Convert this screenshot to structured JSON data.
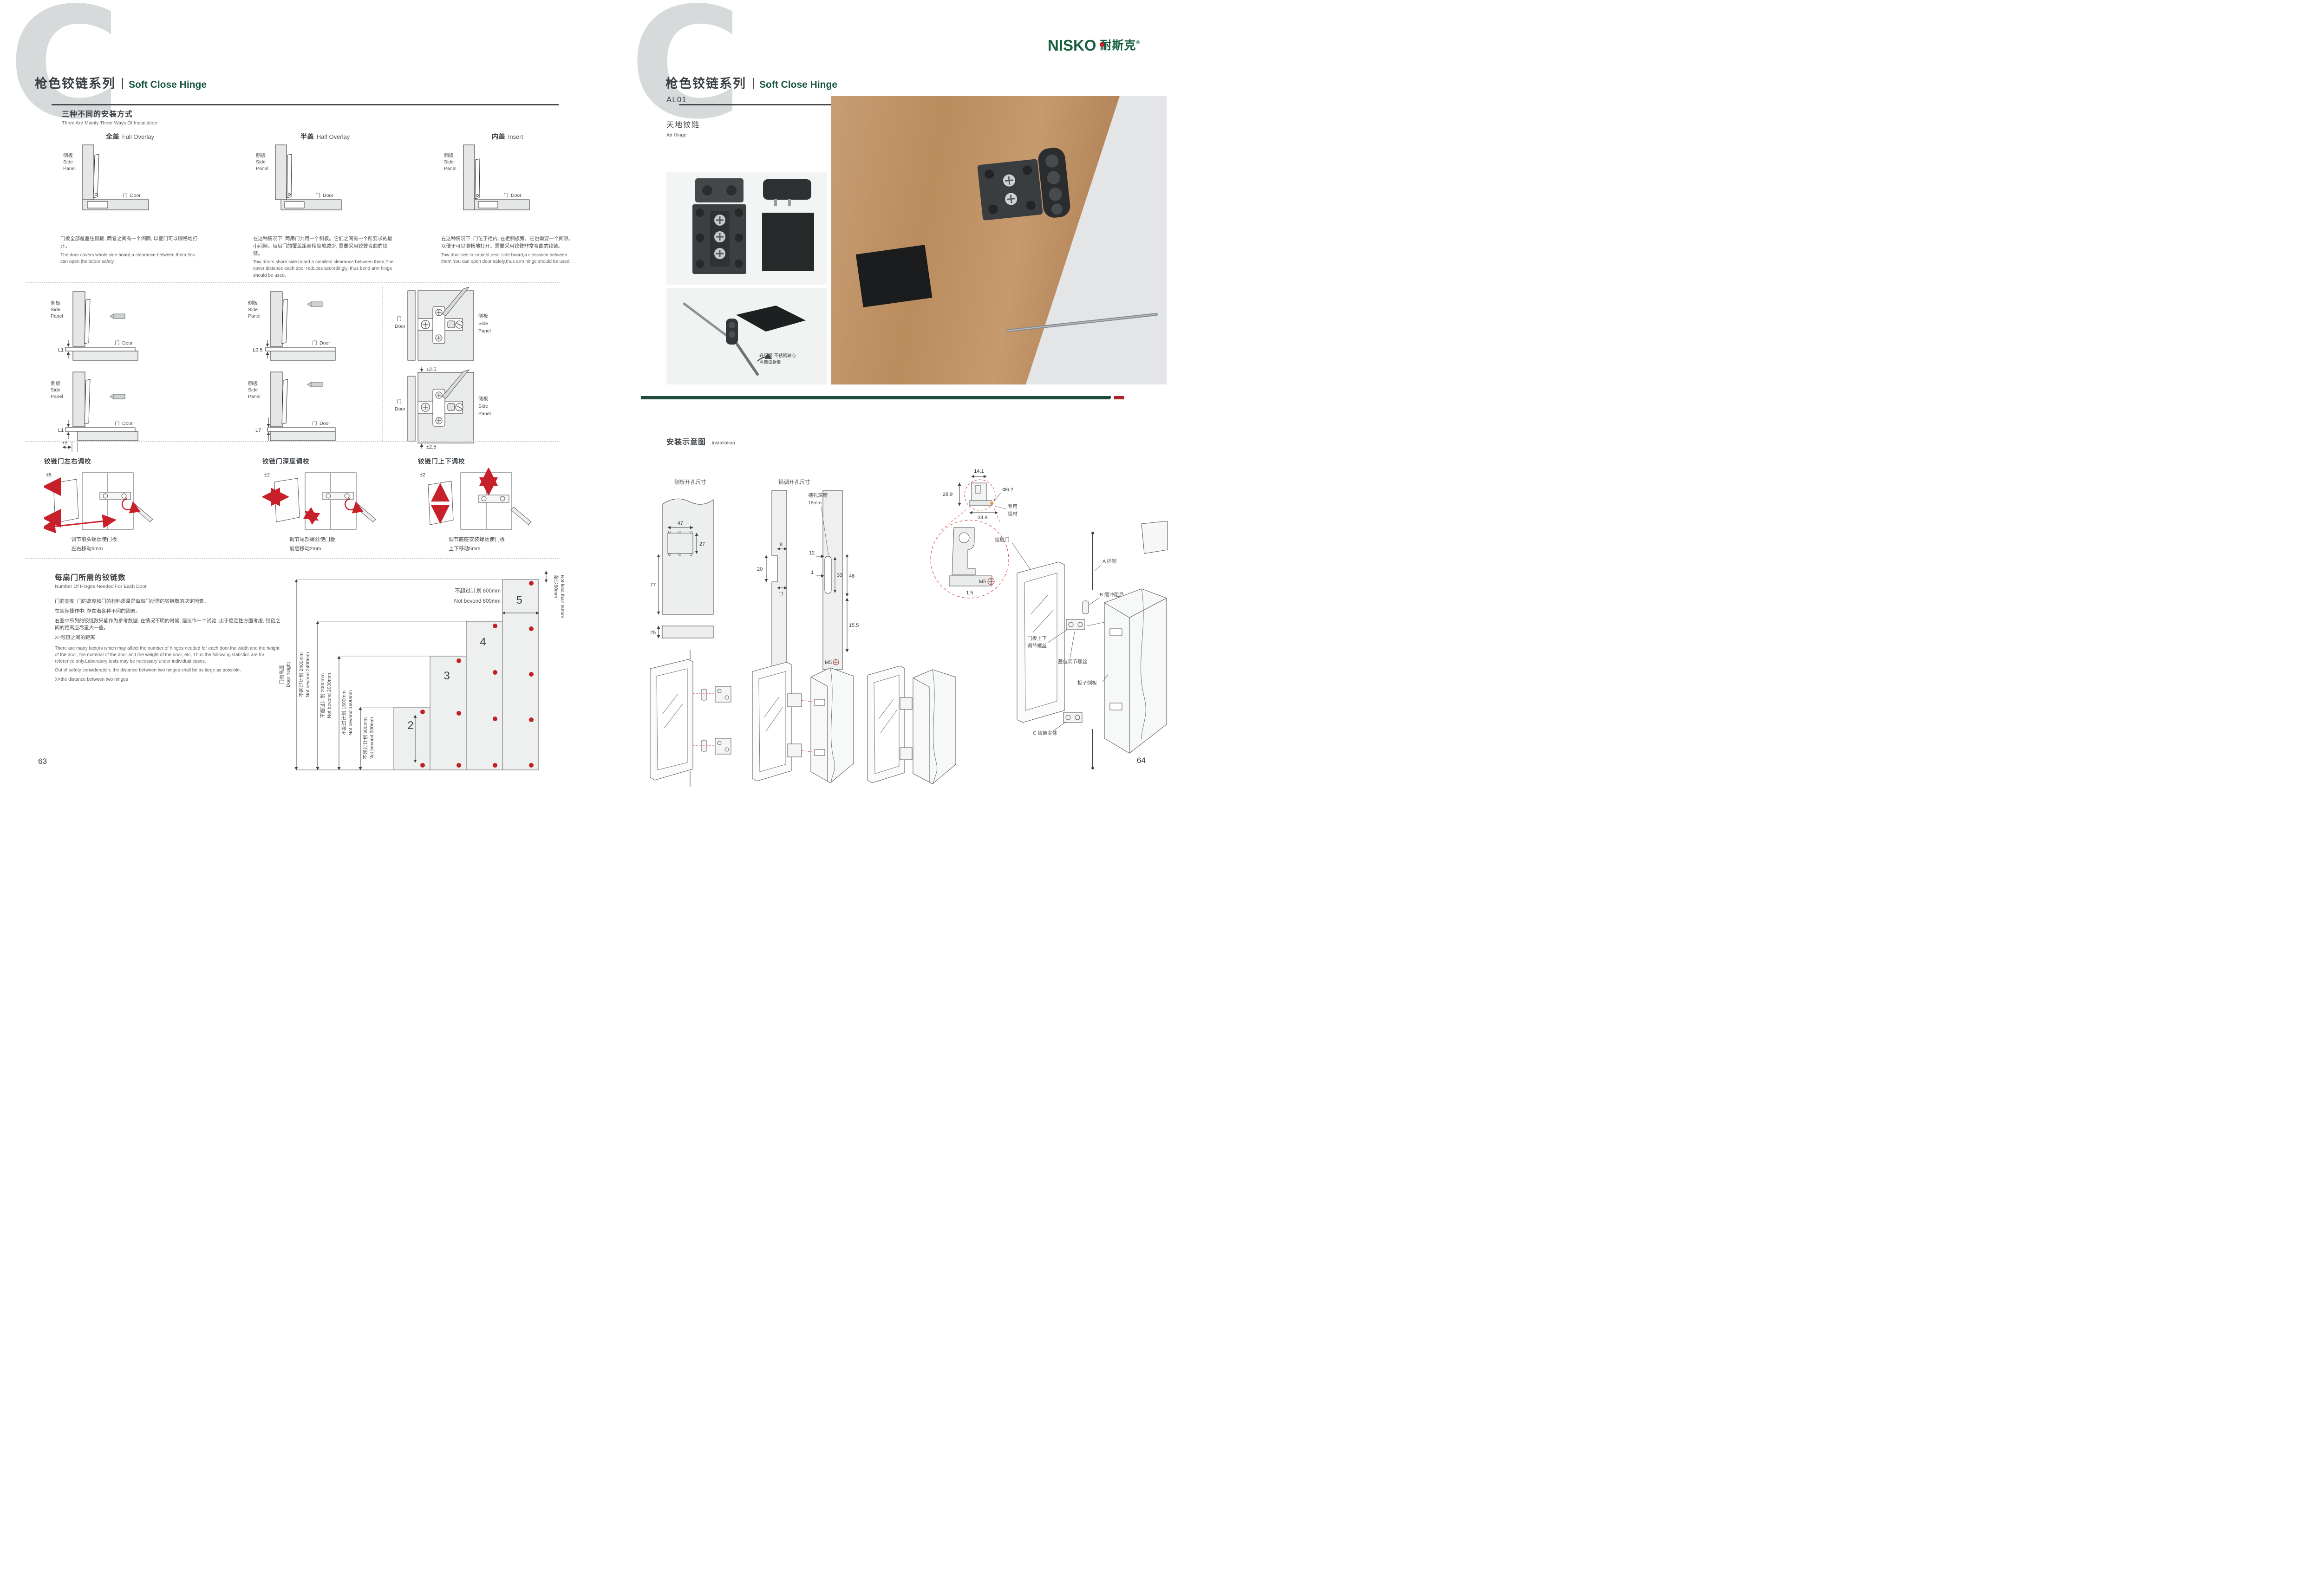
{
  "left": {
    "page_number": "63",
    "header": {
      "series_zh": "枪色铰链系列",
      "series_en": "Soft Close Hinge"
    },
    "ways": {
      "title_zh": "三种不同的安装方式",
      "title_en": "Three Are Mainly Three Ways Of Installation",
      "panel_zh": "侧板",
      "panel_en1": "Side",
      "panel_en2": "Panel",
      "door_zh": "门",
      "door_en": "Door",
      "items": [
        {
          "name_zh": "全盖",
          "name_en": "Full Overlay",
          "desc_zh": "门板全部覆盖住侧板, 两者之间有一个间隙, 以便门可以顺畅地打开。",
          "desc_en": "The door covers whole side board,a clearance between them,You can open the bdoor safely."
        },
        {
          "name_zh": "半盖",
          "name_en": "Half Overlay",
          "desc_zh": "在这种情况下, 两扇门共用一个侧板。它们之间有一个所要求的最小间隙。每扇门的覆盖距离相应地减少, 需要采用铰臂弯曲的铰链。",
          "desc_en": "Tow doors share side board,a smallest clearance between them,The cover distance each door reduces accordingly, thus bend arm hinge should be used."
        },
        {
          "name_zh": "内盖",
          "name_en": "Insert",
          "desc_zh": "在这种情况下, 门位于柜内, 在柜侧板旁。它也需要一个间隙。以便于可以顺畅地打开。需要采用铰臂非常弯曲的铰链。",
          "desc_en": "Tow door lies in cabinet,near side board,a clearance between them.You can open door safely,thus arm hinge should be used."
        }
      ]
    },
    "mid": {
      "dims": [
        {
          "dim": "L1"
        },
        {
          "dim": "L0.5"
        },
        {
          "dim": "L1",
          "extra": "+5"
        },
        {
          "dim": "L7"
        }
      ],
      "plate_dim": "±2.5"
    },
    "adjust": {
      "items": [
        {
          "title": "铰链门左右调校",
          "range": "±5",
          "cap1": "调节前头螺丝使门板",
          "cap2": "左右移动5mm"
        },
        {
          "title": "铰链门深度调校",
          "range": "±2",
          "cap1": "调节尾部螺丝使门板",
          "cap2": "前后移动2mm"
        },
        {
          "title": "铰链门上下调校",
          "range": "±2",
          "cap1": "调节底座安装螺丝使门板",
          "cap2": "上下移动5mm"
        }
      ]
    },
    "hinges": {
      "title_zh": "每扇门所需的铰链数",
      "title_en": "Number Of Hinges Needed For Each Door",
      "zh_p1": "门的宽度, 门的高度和门的材料质量是每扇门所需的铰链数的决定因素。",
      "zh_p2": "在实际操作中, 存在着各种不同的因素。",
      "zh_p3": "右图中所列的铰链数只能作为参考数据, 在情况不明的时候, 建议作一个试验, 出于稳定性方面考虑, 铰链之间的距离应尽量大一些。",
      "zh_p4": "X=铰链之间的距离",
      "en_p1": "There are many factors which may affect the number of hinges needed for each door.the width and the height of the door, the material of the door and the weight of the door, etc, Thus the following statistics are for reference only.Laboratory tests may be necessary under individual cases.",
      "en_p2": "Out of safety consideration, the distance between two hinges shall be as large as possible.",
      "en_p3": "X=the distance between two hinges",
      "chart": {
        "type": "step-bar",
        "ylabel_zh": "门的高度",
        "ylabel_en": "Door height",
        "limits": [
          {
            "zh": "不超过计划 2400mm",
            "en": "Not bevond 2400mm"
          },
          {
            "zh": "不超过计划 2000mm",
            "en": "Not bevond 2000mm"
          },
          {
            "zh": "不超过计划 1600mm",
            "en": "Not bevond 1600mm"
          },
          {
            "zh": "不超过计划 900mm",
            "en": "Not bevond 900mm"
          }
        ],
        "top_zh": "不超过计划 600mm",
        "top_en": "Not bevond 600mm",
        "min_zh": "至少90mm",
        "min_en": "Not less than 90mm",
        "bars": [
          "2",
          "3",
          "4",
          "5"
        ]
      }
    }
  },
  "right": {
    "page_number": "64",
    "header": {
      "series_zh": "枪色铰链系列",
      "series_en": "Soft Close Hinge"
    },
    "logo": {
      "brand": "NISKO",
      "cn": "耐斯克",
      "reg": "®"
    },
    "product": {
      "code": "AL01",
      "name_zh": "天地铰链",
      "name_en": "Air Hinge"
    },
    "annotation": {
      "l1": "升级版·不锈钢轴心",
      "l2": "可自由拆卸"
    },
    "install": {
      "title_zh": "安装示意图",
      "title_en": "Installation",
      "side_title": "侧板开孔尺寸",
      "alu_title": "铝调开孔尺寸",
      "side": {
        "d47": "47",
        "d27": "27",
        "d77": "77",
        "d25": "25"
      },
      "alu": {
        "d8": "8",
        "d20": "20",
        "d11": "11",
        "d12": "12",
        "d1": "1",
        "d33": "33",
        "d46": "46",
        "d155": "15.5",
        "m5": "M5",
        "slot1": "槽孔深度",
        "slot2": "18mm"
      },
      "detail": {
        "d141": "14.1",
        "d289": "28.9",
        "dia": "Φ6.2",
        "d349": "34.9",
        "mat1": "专用",
        "mat2": "铝材",
        "m5": "M5",
        "scale": "1:5"
      },
      "exploded": {
        "frame": "铝框门",
        "pin": "A 插销",
        "damper": "B 缓冲阻尼",
        "fb1": "门板前后",
        "fb2": "调节螺丝",
        "ud1": "门板上下",
        "ud2": "调节螺丝",
        "cover": "盖位调节螺丝",
        "cabinet": "柜子侧板",
        "body": "C 铰链主体"
      }
    }
  }
}
